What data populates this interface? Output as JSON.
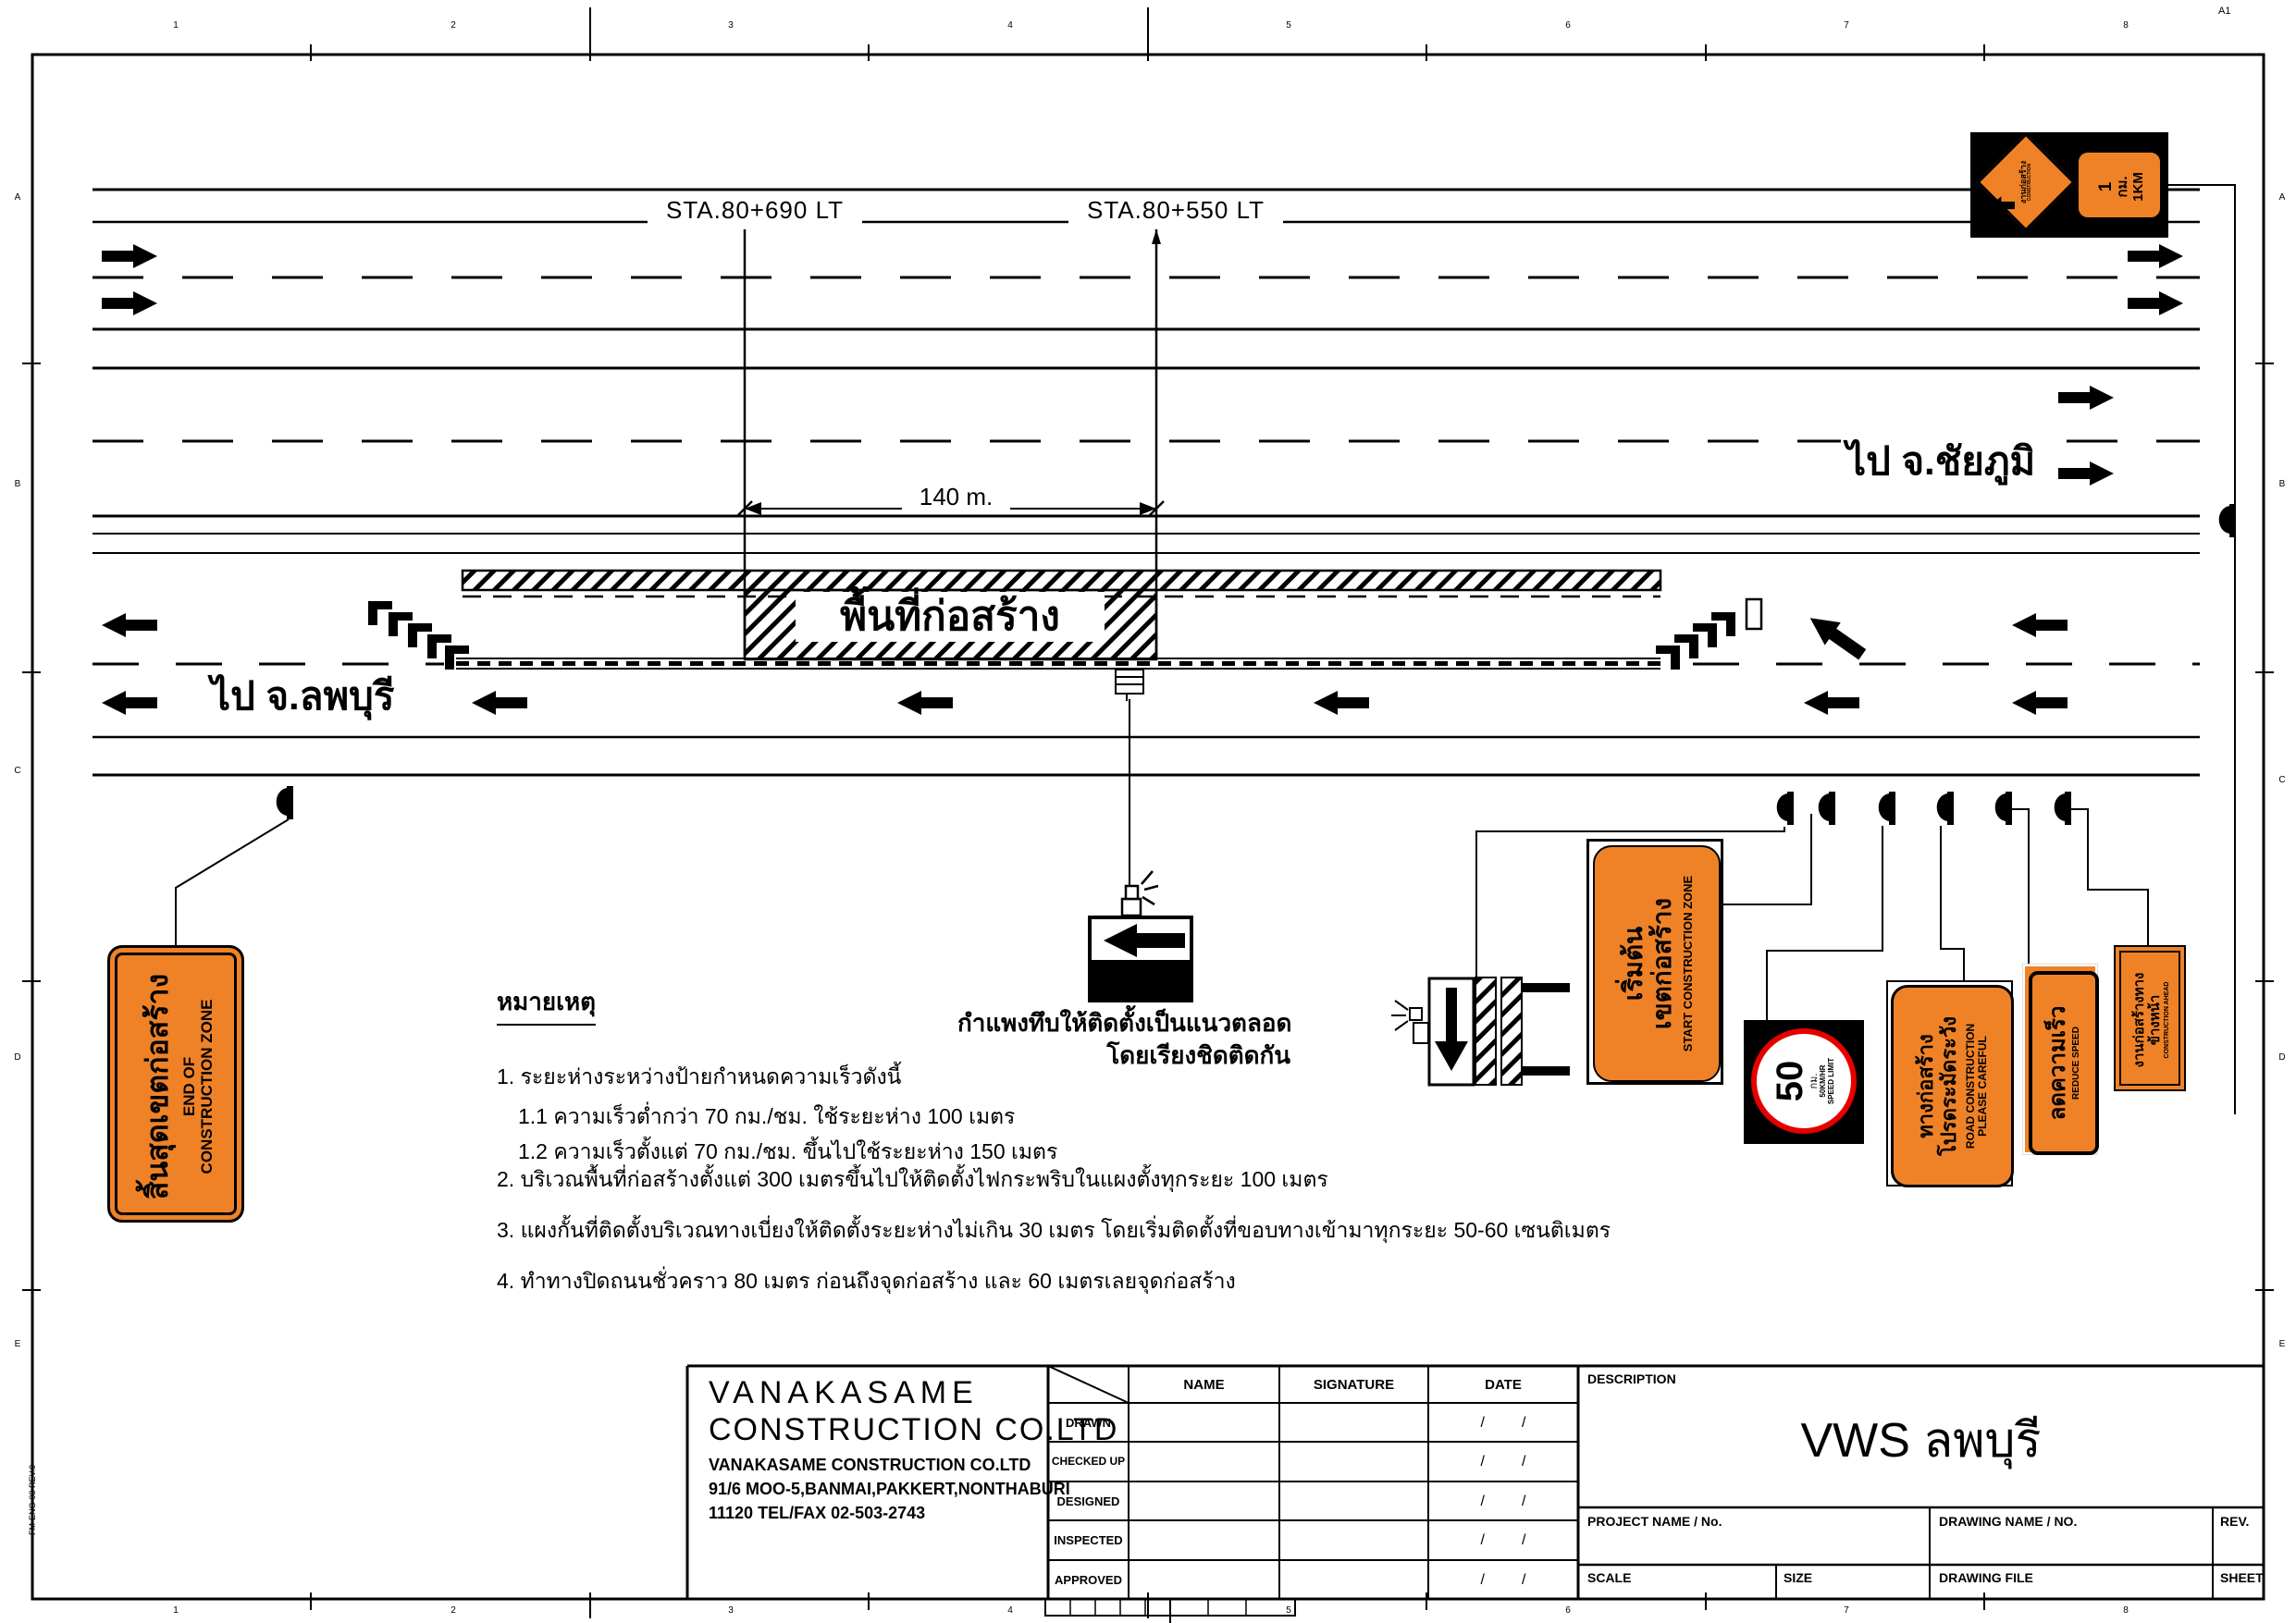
{
  "colors": {
    "orange": "#EF8227",
    "red": "#E60000",
    "black": "#000000"
  },
  "frame": {
    "corner": "A1",
    "form_ref": "FM-ENG-03 REV.0",
    "cols": [
      "1",
      "2",
      "3",
      "4",
      "5",
      "6",
      "7",
      "8"
    ],
    "rows": [
      "A",
      "B",
      "C",
      "D",
      "E"
    ]
  },
  "plan": {
    "sta_left": "STA.80+690 LT",
    "sta_right": "STA.80+550 LT",
    "dim": "140 m.",
    "work_area": "พื้นที่ก่อสร้าง",
    "to_right": "ไป จ.ชัยภูมิ",
    "to_left": "ไป จ.ลพบุรี",
    "wall_note1": "กำแพงทึบให้ติดตั้งเป็นแนวตลอด",
    "wall_note2": "โดยเรียงชิดติดกัน"
  },
  "notes": {
    "title": "หมายเหตุ",
    "items": [
      "1.  ระยะห่างระหว่างป้ายกำหนดความเร็วดังนี้",
      "1.1  ความเร็วต่ำกว่า 70  กม./ชม.  ใช้ระยะห่าง 100  เมตร",
      "1.2  ความเร็วตั้งแต่ 70  กม./ชม.  ขึ้นไปใช้ระยะห่าง 150  เมตร",
      "2.  บริเวณพื้นที่ก่อสร้างตั้งแต่ 300  เมตรขึ้นไปให้ติดตั้งไฟกระพริบในแผงตั้งทุกระยะ 100  เมตร",
      "3.  แผงกั้นที่ติดตั้งบริเวณทางเบี่ยงให้ติดตั้งระยะห่างไม่เกิน 30  เมตร โดยเริ่มติดตั้งที่ขอบทางเข้ามาทุกระยะ 50-60  เซนติเมตร",
      "4.  ทำทางปิดถนนชั่วคราว 80  เมตร ก่อนถึงจุดก่อสร้าง และ 60  เมตรเลยจุดก่อสร้าง"
    ]
  },
  "signs": {
    "km_marker": {
      "diamond_thai": "งานก่อสร้าง",
      "diamond_en": "CONSTRUCTION",
      "panel1": "1",
      "panel2": "กม.",
      "panel3": "1KM"
    },
    "end_zone": {
      "thai": "สิ้นสุดเขตก่อสร้าง",
      "en1": "END OF",
      "en2": "CONSTRUCTION ZONE"
    },
    "start_zone": {
      "thai1": "เริ่มต้น",
      "thai2": "เขตก่อสร้าง",
      "en": "START CONSTRUCTION ZONE"
    },
    "speed": {
      "value": "50",
      "unit": "กม.",
      "en1": "50KM/HR",
      "en2": "SPEED LIMIT"
    },
    "road_construction": {
      "thai1": "ทางก่อสร้าง",
      "thai2": "โปรดระมัดระวัง",
      "en1": "ROAD CONSTRUCTION",
      "en2": "PLEASE CAREFUL"
    },
    "reduce_speed": {
      "thai": "ลดความเร็ว",
      "en": "REDUCE SPEED"
    },
    "construction_ahead": {
      "thai1": "งานก่อสร้างทาง",
      "thai2": "ข้างหน้า",
      "en": "CONSTRUCTION AHEAD"
    }
  },
  "title_block": {
    "company_name1": "VANAKASAME",
    "company_name2": "CONSTRUCTION  CO.LTD",
    "addr1": "VANAKASAME  CONSTRUCTION  CO.LTD",
    "addr2": "91/6   MOO-5,BANMAI,PAKKERT,NONTHABURI",
    "addr3": "11120  TEL/FAX  02-503-2743",
    "col_name": "NAME",
    "col_sig": "SIGNATURE",
    "col_date": "DATE",
    "rows": [
      "DRAWN",
      "CHECKED UP",
      "DESIGNED",
      "INSPECTED",
      "APPROVED"
    ],
    "date_placeholder": "/         /",
    "description_label": "DESCRIPTION",
    "description": "VWS ลพบุรี",
    "project_label": "PROJECT NAME / No.",
    "drawing_label": "DRAWING NAME / NO.",
    "rev_label": "REV.",
    "scale_label": "SCALE",
    "size_label": "SIZE",
    "file_label": "DRAWING FILE",
    "sheet_label": "SHEET"
  }
}
